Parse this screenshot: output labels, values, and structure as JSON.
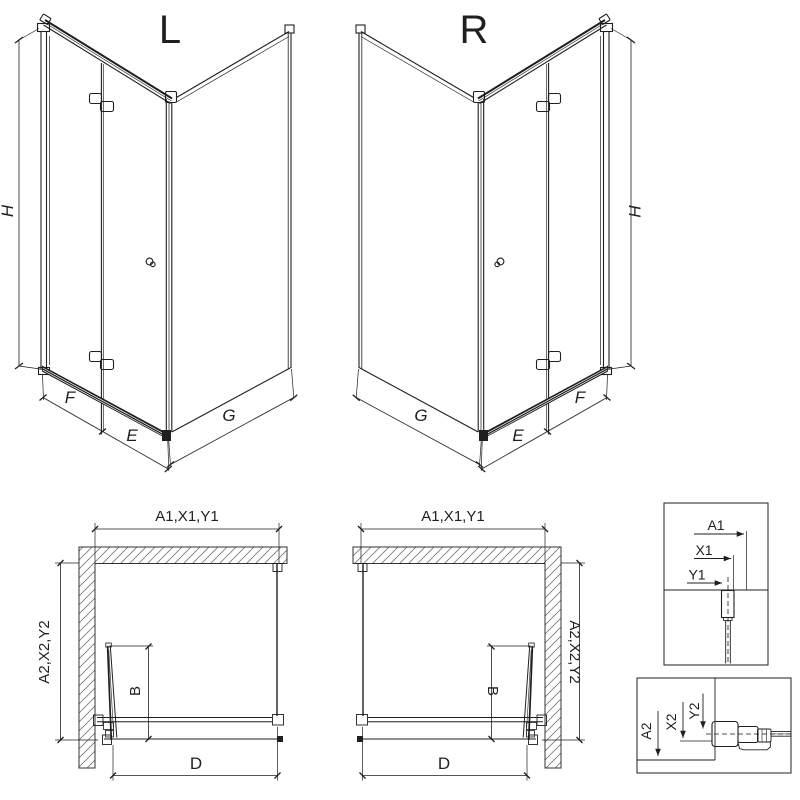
{
  "colors": {
    "line": "#1f1f1f",
    "hatch": "#777777",
    "background": "#ffffff"
  },
  "iso_views": [
    {
      "variant": "L",
      "height_dim": "H",
      "door_panel_dim": "F",
      "door_inner_dim": "E",
      "side_panel_dim": "G"
    },
    {
      "variant": "R",
      "height_dim": "H",
      "door_panel_dim": "F",
      "door_inner_dim": "E",
      "side_panel_dim": "G"
    }
  ],
  "plan_views": [
    {
      "variant": "L",
      "width_dim": "A1,X1,Y1",
      "depth_dim": "A2,X2,Y2",
      "fold_dim": "B",
      "entry_dim": "D"
    },
    {
      "variant": "R",
      "width_dim": "A1,X1,Y1",
      "depth_dim": "A2,X2,Y2",
      "fold_dim": "B",
      "entry_dim": "D"
    }
  ],
  "detail_boxes": [
    {
      "dims": [
        "A1",
        "X1",
        "Y1"
      ]
    },
    {
      "dims": [
        "A2",
        "X2",
        "Y2"
      ]
    }
  ]
}
